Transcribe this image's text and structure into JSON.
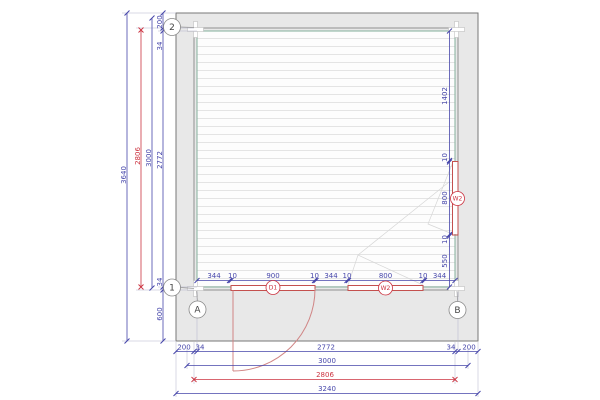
{
  "plan": {
    "title": "floor-plan-drawing",
    "grids": {
      "two": "2",
      "one": "1",
      "a": "A",
      "b": "B"
    },
    "openings": {
      "door_label": "D1",
      "window_bottom_label": "W2",
      "window_right_label": "W2"
    },
    "dims_left": {
      "overall": "3640",
      "wall": "2806",
      "axis": "3000",
      "chain": [
        "200",
        "34",
        "2772",
        "34",
        "600"
      ]
    },
    "dims_bottom": {
      "chain": [
        "200",
        "34",
        "2772",
        "34",
        "200"
      ],
      "axis": "3000",
      "wall": "2806",
      "overall": "3240"
    },
    "dims_inner_bottom": [
      "344",
      "10",
      "900",
      "10",
      "344",
      "10",
      "800",
      "10",
      "344"
    ],
    "dims_inner_right": [
      "1402",
      "10",
      "800",
      "10",
      "550"
    ],
    "colors": {
      "dimension_blue": "#4646aa",
      "dimension_red": "#cc3340",
      "wall_gray": "#8f8f8f",
      "inner_face_green": "#84b09c",
      "overhang_fill": "#e8e8e8",
      "opening_red": "#c4504e",
      "door_swing_pink": "#d08585"
    }
  }
}
